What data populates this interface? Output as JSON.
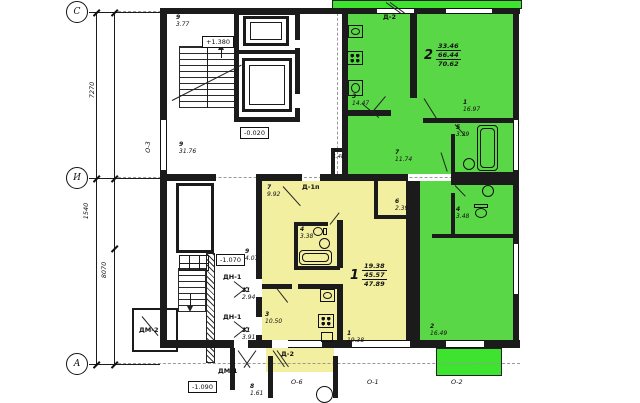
{
  "drawing": {
    "type": "residential floor plan"
  },
  "colors": {
    "apartment1_fill": "#f2efa0",
    "apartment2_fill": "#5ad746",
    "balcony_fill": "#3ee32f",
    "wall": "#1b1b1b"
  },
  "grid": {
    "bubbles": [
      {
        "label": "С"
      },
      {
        "label": "И"
      },
      {
        "label": "А"
      }
    ],
    "dims": [
      {
        "value": "7270"
      },
      {
        "value": "1540"
      },
      {
        "value": "8070"
      }
    ]
  },
  "elevations": {
    "stair_mid": "+1.380",
    "ground": "-0.020",
    "stair_low": "-1.070",
    "entry": "-1.090"
  },
  "openings": {
    "window_o3": "О-3",
    "window_o6": "О-6",
    "window_o1": "О-1",
    "window_o2": "О-2",
    "door_d2_top": "Д-2",
    "door_d1p": "Д-1п",
    "door_d2_bottom": "Д-2",
    "door_dn1_upper": "ДН-1",
    "door_dn1_lower": "ДН-1",
    "door_dm1": "ДМ-1",
    "door_dm2": "ДМ-2"
  },
  "common": {
    "rooms": [
      {
        "num": "9",
        "area": "3.77"
      },
      {
        "num": "9",
        "area": "31.76"
      },
      {
        "num": "9",
        "area": "4.07"
      },
      {
        "num": "11",
        "area": "2.94"
      },
      {
        "num": "11",
        "area": "3.91"
      },
      {
        "num": "8",
        "area": "1.61"
      },
      {
        "num": "7",
        "area": "1.48"
      }
    ]
  },
  "apartments": [
    {
      "number": "1",
      "totals": {
        "living": "19.38",
        "usable": "45.57",
        "total": "47.89"
      },
      "rooms": [
        {
          "num": "7",
          "area": "9.92"
        },
        {
          "num": "4",
          "area": "3.38"
        },
        {
          "num": "6",
          "area": "2.39"
        },
        {
          "num": "3",
          "area": "10.50"
        },
        {
          "num": "1",
          "area": "19.38"
        }
      ]
    },
    {
      "number": "2",
      "totals": {
        "living": "33.46",
        "usable": "66.44",
        "total": "70.62"
      },
      "rooms": [
        {
          "num": "3",
          "area": "14.47"
        },
        {
          "num": "1",
          "area": "16.97"
        },
        {
          "num": "5",
          "area": "3.29"
        },
        {
          "num": "7",
          "area": "11.74"
        },
        {
          "num": "4",
          "area": "3.48"
        },
        {
          "num": "2",
          "area": "16.49"
        }
      ]
    }
  ]
}
